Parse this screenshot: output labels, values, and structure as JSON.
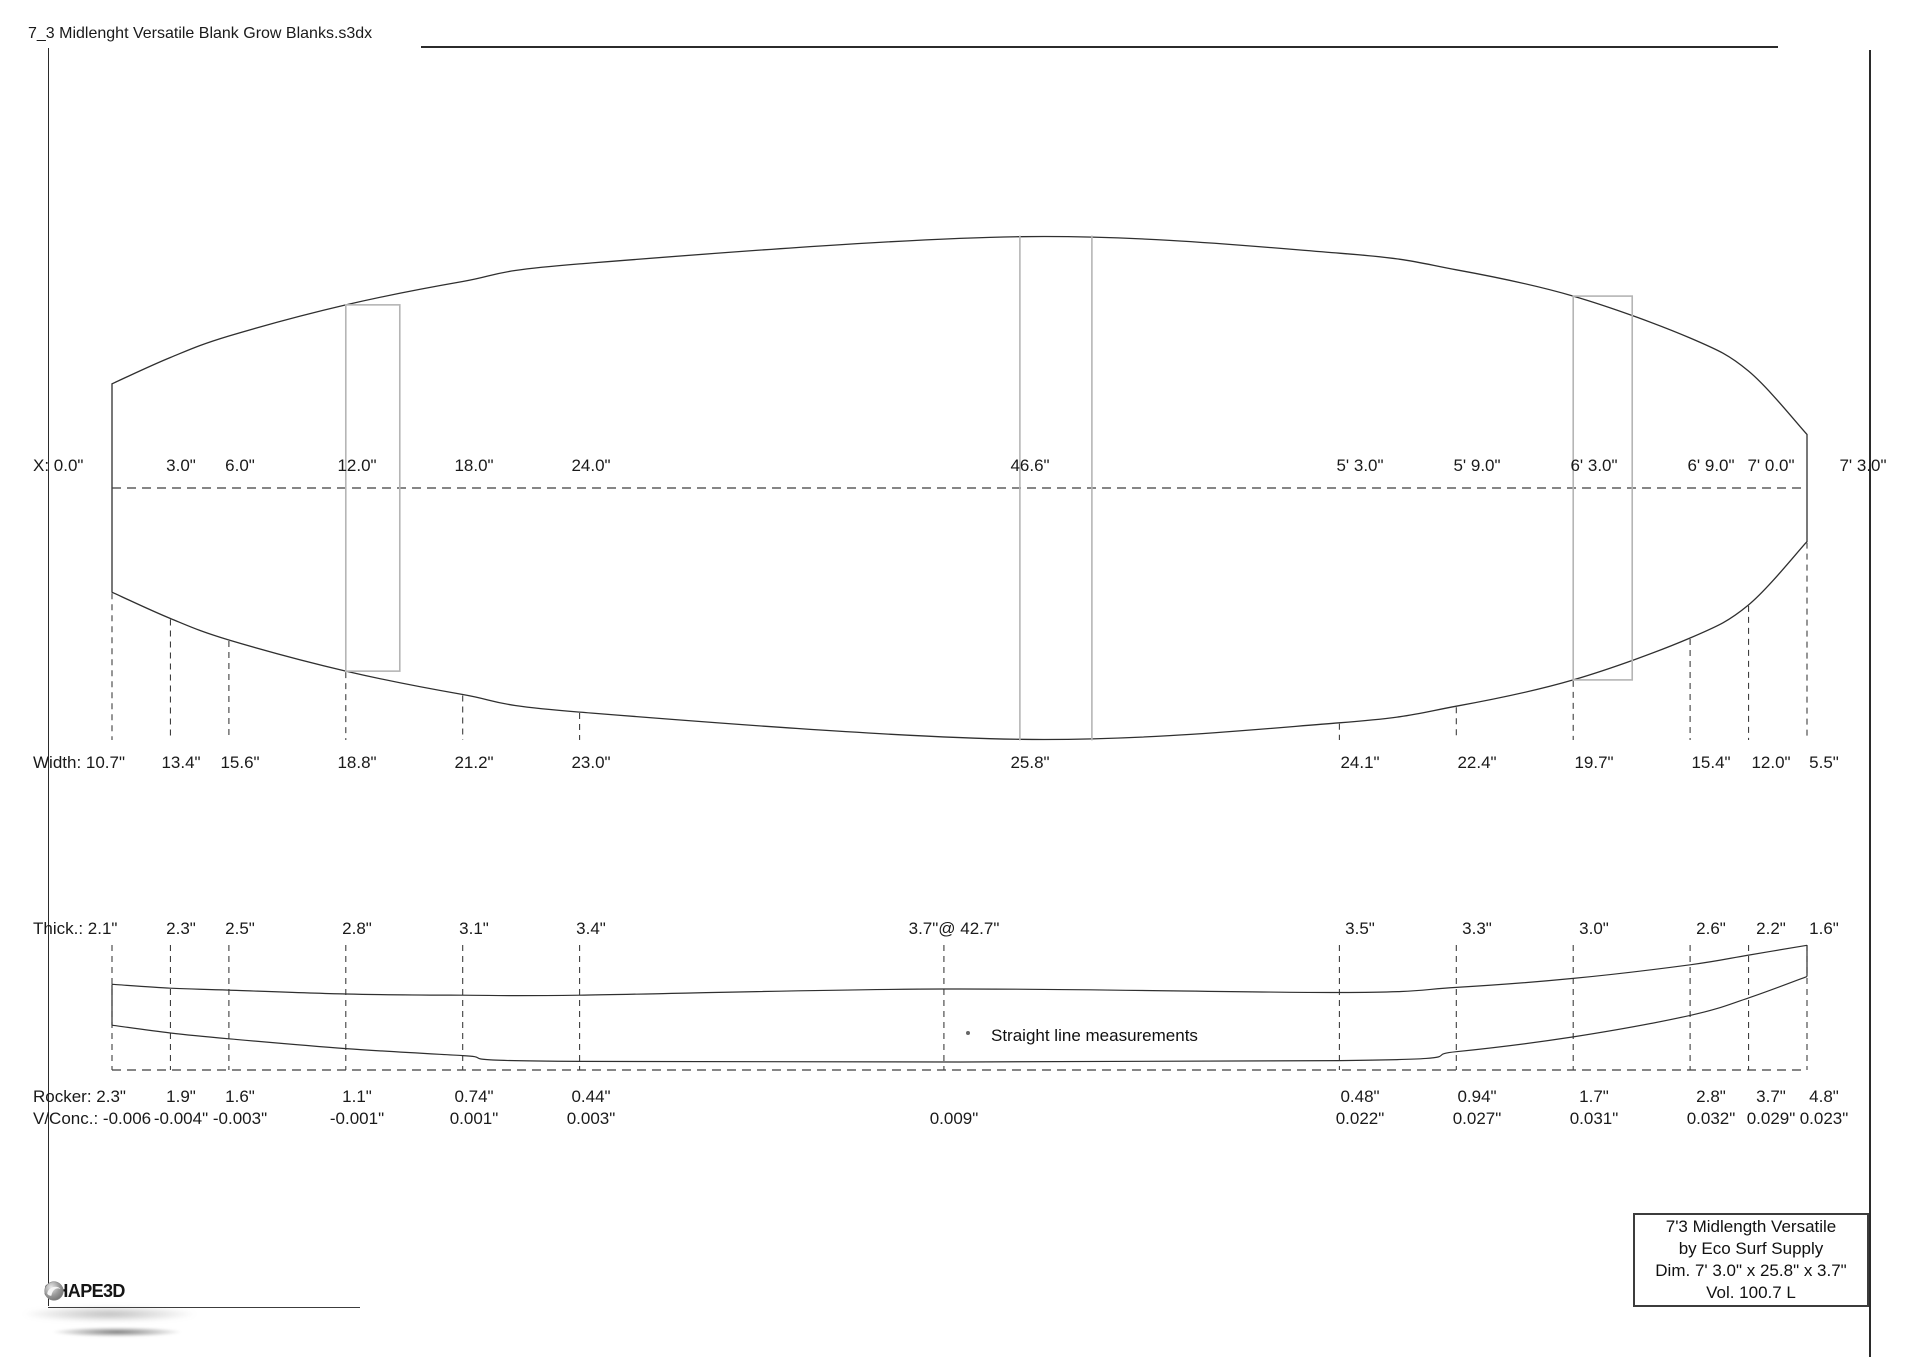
{
  "header": {
    "filename": "7_3 Midlenght Versatile Blank Grow Blanks.s3dx"
  },
  "note": {
    "text": "Straight line measurements"
  },
  "label_box": {
    "line1": "7'3 Midlength Versatile",
    "line2": "by Eco Surf Supply",
    "line3": "Dim. 7' 3.0\" x 25.8\" x 3.7\"",
    "line4": "Vol. 100.7 L"
  },
  "footer": {
    "logo_text": "SHAPE3D"
  },
  "colors": {
    "outline": "#2f2f2f",
    "dashed": "#3f3f3f",
    "overlay": "#b5b5b5",
    "border": "#2b2b2b",
    "text": "#1a1a1a"
  },
  "measurements": {
    "rows": [
      {
        "name": "x_row",
        "prefix": "X: ",
        "stations_in": [
          0,
          3,
          6,
          12,
          18,
          24,
          46.6,
          63,
          69,
          75,
          81,
          84,
          87
        ],
        "values": [
          "0.0\"",
          "3.0\"",
          "6.0\"",
          "12.0\"",
          "18.0\"",
          "24.0\"",
          "46.6\"",
          "5' 3.0\"",
          "5' 9.0\"",
          "6' 3.0\"",
          "6' 9.0\"",
          "7' 0.0\"",
          "7' 3.0\""
        ]
      },
      {
        "name": "width_row",
        "prefix": "Width: ",
        "stations_in": [
          0,
          3,
          6,
          12,
          18,
          24,
          46.6,
          63,
          69,
          75,
          81,
          84,
          87
        ],
        "values": [
          "10.7\"",
          "13.4\"",
          "15.6\"",
          "18.8\"",
          "21.2\"",
          "23.0\"",
          "25.8\"",
          "24.1\"",
          "22.4\"",
          "19.7\"",
          "15.4\"",
          "12.0\"",
          "5.5\""
        ]
      },
      {
        "name": "thick_row",
        "prefix": "Thick.: ",
        "stations_in": [
          0,
          3,
          6,
          12,
          18,
          24,
          42.7,
          63,
          69,
          75,
          81,
          84,
          87
        ],
        "values": [
          "2.1\"",
          "2.3\"",
          "2.5\"",
          "2.8\"",
          "3.1\"",
          "3.4\"",
          "3.7\"@ 42.7\"",
          "3.5\"",
          "3.3\"",
          "3.0\"",
          "2.6\"",
          "2.2\"",
          "1.6\""
        ]
      },
      {
        "name": "rocker_row",
        "prefix": "Rocker: ",
        "stations_in": [
          0,
          3,
          6,
          12,
          18,
          24,
          63,
          69,
          75,
          81,
          84,
          87
        ],
        "values": [
          "2.3\"",
          "1.9\"",
          "1.6\"",
          "1.1\"",
          "0.74\"",
          "0.44\"",
          "0.48\"",
          "0.94\"",
          "1.7\"",
          "2.8\"",
          "3.7\"",
          "4.8\""
        ]
      },
      {
        "name": "vconc_row",
        "prefix": "V/Conc.: ",
        "stations_in": [
          0,
          3,
          6,
          12,
          18,
          24,
          42.7,
          63,
          69,
          75,
          81,
          84,
          87
        ],
        "values": [
          "-0.006",
          "-0.004\"",
          "-0.003\"",
          "-0.001\"",
          "0.001\"",
          "0.003\"",
          "0.009\"",
          "0.022\"",
          "0.027\"",
          "0.031\"",
          "0.032\"",
          "0.029\"",
          "0.023\""
        ]
      }
    ]
  },
  "geometry": {
    "length_in": 87,
    "outline": {
      "stations_in": [
        0,
        3,
        6,
        12,
        18,
        24,
        46.6,
        63,
        69,
        75,
        81,
        84,
        87
      ],
      "widths_in": [
        10.7,
        13.4,
        15.6,
        18.8,
        21.2,
        23.0,
        25.8,
        24.1,
        22.4,
        19.7,
        15.4,
        12.0,
        5.5
      ]
    },
    "profile": {
      "thickness_stations_in": [
        0,
        3,
        6,
        12,
        18,
        24,
        42.7,
        63,
        69,
        75,
        81,
        84,
        87
      ],
      "thickness_in": [
        2.1,
        2.3,
        2.5,
        2.8,
        3.1,
        3.4,
        3.7,
        3.5,
        3.3,
        3.0,
        2.6,
        2.2,
        1.6
      ],
      "rocker_stations_in": [
        0,
        3,
        6,
        12,
        18,
        24,
        63,
        69,
        75,
        81,
        84,
        87
      ],
      "rocker_in": [
        2.3,
        1.9,
        1.6,
        1.1,
        0.74,
        0.44,
        0.48,
        0.94,
        1.7,
        2.8,
        3.7,
        4.8
      ],
      "vconc_in": [
        -0.006,
        -0.004,
        -0.003,
        -0.001,
        0.001,
        0.003,
        0.009,
        0.022,
        0.027,
        0.031,
        0.032,
        0.029,
        0.023
      ]
    }
  }
}
